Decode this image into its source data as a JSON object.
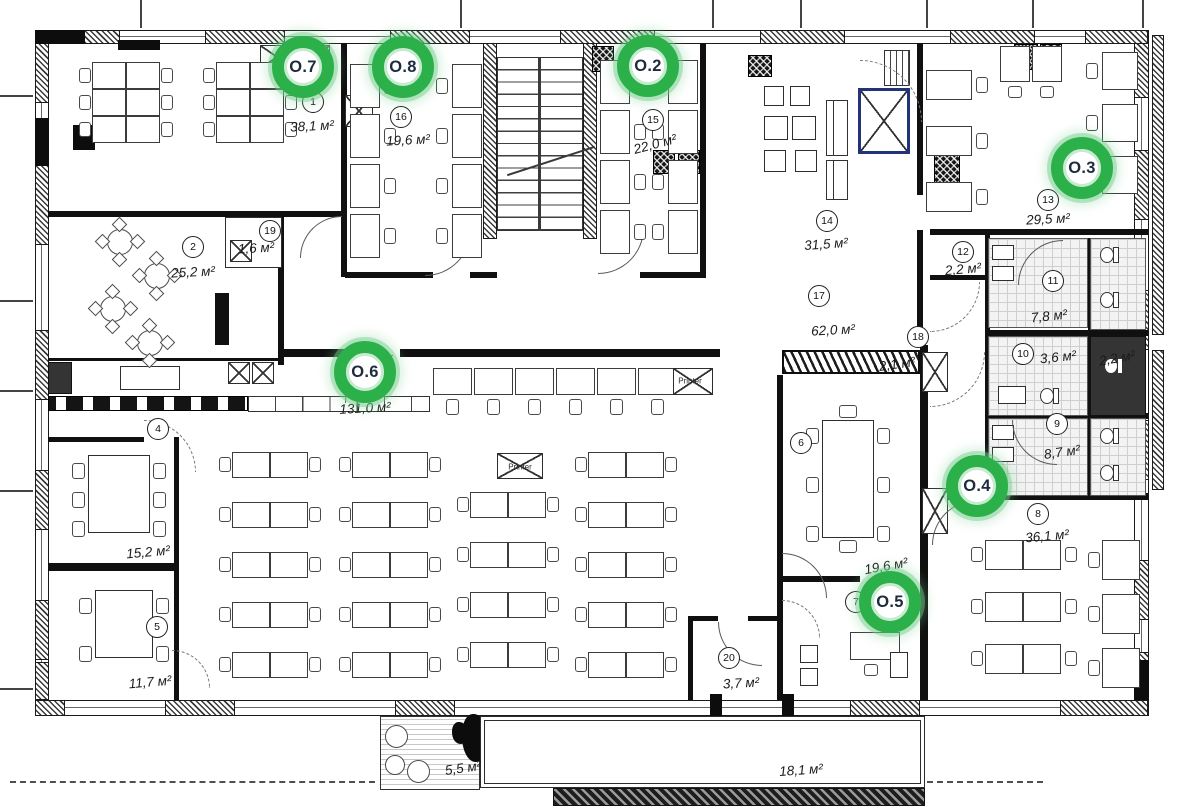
{
  "plan": {
    "title": "office-floor-plan",
    "colors": {
      "marker_green": "#2cb14a",
      "marker_halo": "rgba(116,206,140,0.45)",
      "marker_text": "#1d2b3e",
      "wall": "#101010"
    },
    "markers": [
      {
        "id": "O.7",
        "label": "O.7",
        "x": 303,
        "y": 67
      },
      {
        "id": "O.8",
        "label": "O.8",
        "x": 403,
        "y": 67
      },
      {
        "id": "O.2",
        "label": "O.2",
        "x": 648,
        "y": 66
      },
      {
        "id": "O.3",
        "label": "O.3",
        "x": 1082,
        "y": 168
      },
      {
        "id": "O.6",
        "label": "O.6",
        "x": 365,
        "y": 372
      },
      {
        "id": "O.4",
        "label": "O.4",
        "x": 977,
        "y": 486
      },
      {
        "id": "O.5",
        "label": "O.5",
        "x": 890,
        "y": 602
      }
    ],
    "rooms": [
      {
        "number": "1",
        "area": "38,1 м²",
        "nx": 313,
        "ny": 102,
        "ax": 312,
        "ay": 126,
        "rot": -3
      },
      {
        "number": "16",
        "area": "19,6 м²",
        "nx": 401,
        "ny": 117,
        "ax": 408,
        "ay": 140,
        "rot": -3
      },
      {
        "number": "15",
        "area": "22,0 м²",
        "nx": 653,
        "ny": 120,
        "ax": 655,
        "ay": 144,
        "rot": -15
      },
      {
        "number": "13",
        "area": "29,5 м²",
        "nx": 1048,
        "ny": 200,
        "ax": 1048,
        "ay": 219,
        "rot": -3
      },
      {
        "number": "14",
        "area": "31,5 м²",
        "nx": 827,
        "ny": 221,
        "ax": 826,
        "ay": 244,
        "rot": -4
      },
      {
        "number": "12",
        "area": "2,2 м²",
        "nx": 963,
        "ny": 252,
        "ax": 963,
        "ay": 269,
        "rot": -5
      },
      {
        "number": "11",
        "area": "7,8 м²",
        "nx": 1053,
        "ny": 281,
        "ax": 1049,
        "ay": 316,
        "rot": -6
      },
      {
        "number": "17",
        "area": "62,0 м²",
        "nx": 819,
        "ny": 296,
        "ax": 833,
        "ay": 330,
        "rot": -3
      },
      {
        "number": "18",
        "area": "2,1 м²",
        "nx": 918,
        "ny": 337,
        "ax": 897,
        "ay": 364,
        "rot": -8
      },
      {
        "number": "10",
        "area": "3,6 м²",
        "nx": 1023,
        "ny": 354,
        "ax": 1058,
        "ay": 357,
        "rot": -6
      },
      {
        "number": "9",
        "area": "8,7 м²",
        "nx": 1057,
        "ny": 424,
        "ax": 1062,
        "ay": 452,
        "rot": -8
      },
      {
        "number": "8",
        "area": "36,1 м²",
        "nx": 1038,
        "ny": 514,
        "ax": 1047,
        "ay": 536,
        "rot": -5
      },
      {
        "number": "2",
        "area": "25,2 м²",
        "nx": 193,
        "ny": 247,
        "ax": 193,
        "ay": 272,
        "rot": -3
      },
      {
        "number": "19",
        "area": "1,6 м²",
        "nx": 270,
        "ny": 231,
        "ax": 256,
        "ay": 248,
        "rot": -3
      },
      {
        "number": "4",
        "area": "",
        "nx": 158,
        "ny": 429,
        "ax": 0,
        "ay": 0,
        "rot": 0
      },
      {
        "number": "5",
        "area": "11,7 м²",
        "nx": 157,
        "ny": 627,
        "ax": 150,
        "ay": 682,
        "rot": -5
      },
      {
        "number": "6",
        "area": "",
        "nx": 801,
        "ny": 443,
        "ax": 0,
        "ay": 0,
        "rot": 0
      },
      {
        "number": "7",
        "area": "19,6 м²",
        "nx": 856,
        "ny": 602,
        "ax": 886,
        "ay": 566,
        "rot": -10
      },
      {
        "number": "20",
        "area": "3,7 м²",
        "nx": 729,
        "ny": 658,
        "ax": 741,
        "ay": 683,
        "rot": -3
      }
    ],
    "free_labels": [
      {
        "text": "131,0 м²",
        "x": 365,
        "y": 408,
        "rot": -3
      },
      {
        "text": "15,2 м²",
        "x": 148,
        "y": 552,
        "rot": -5
      },
      {
        "text": "2,2 м²",
        "x": 1117,
        "y": 358,
        "rot": -10
      },
      {
        "text": "5,5 м²",
        "x": 463,
        "y": 768,
        "rot": -8
      },
      {
        "text": "18,1 м²",
        "x": 801,
        "y": 770,
        "rot": -4
      }
    ],
    "printer_labels": [
      {
        "text": "Printer",
        "x": 690,
        "y": 381
      },
      {
        "text": "Printer",
        "x": 520,
        "y": 467
      }
    ]
  }
}
